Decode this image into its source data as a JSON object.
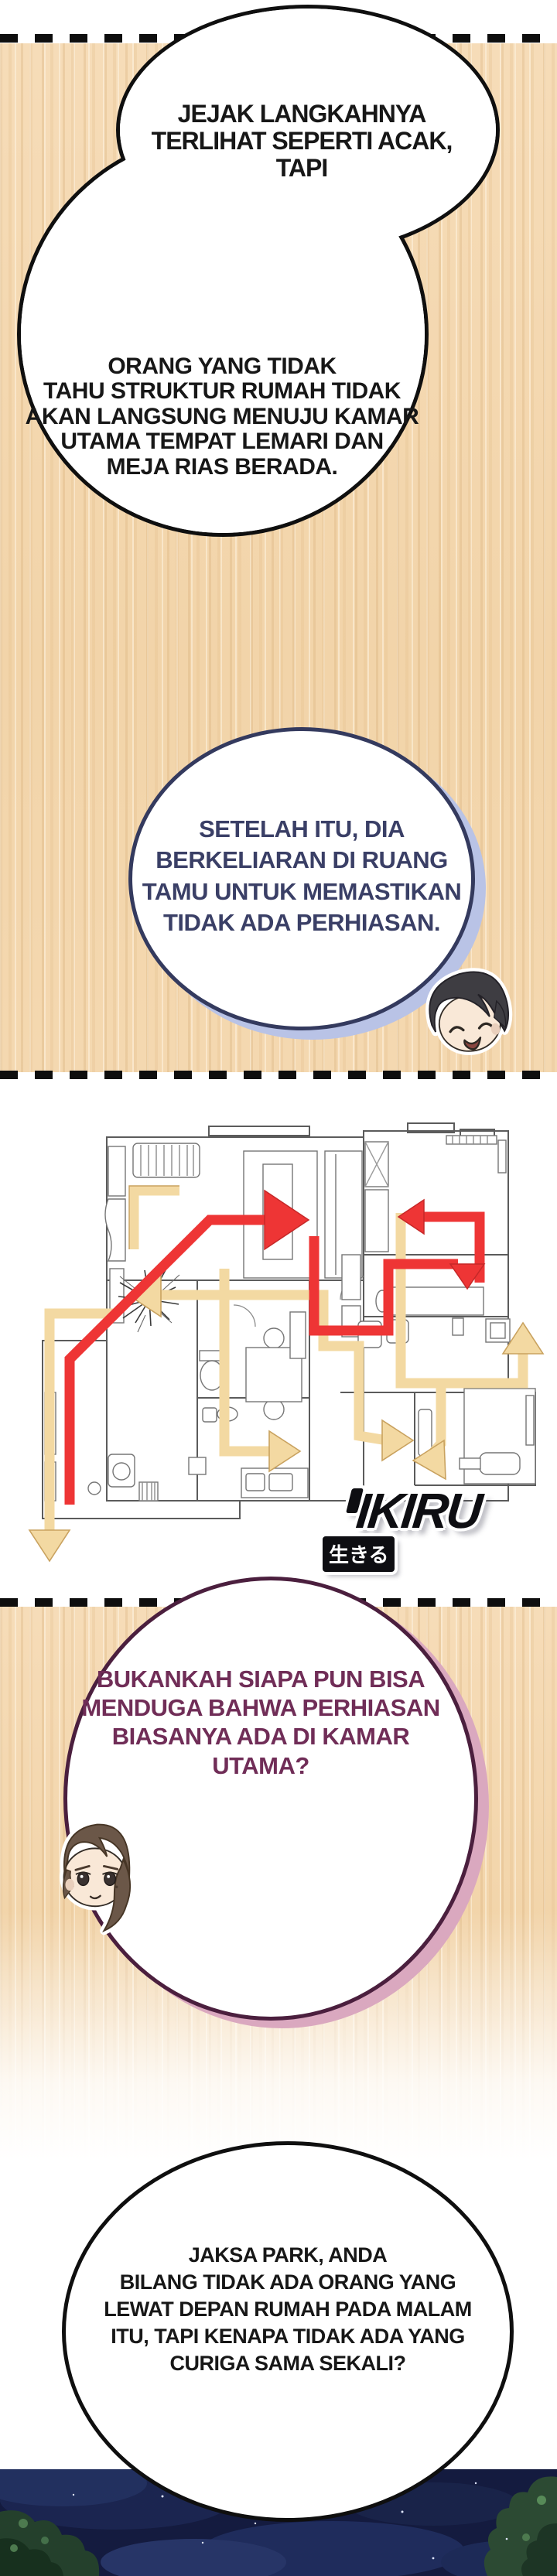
{
  "page": {
    "kind": "webtoon-comic-page",
    "language": "Indonesian"
  },
  "bubbles": [
    {
      "id": "bubble-1",
      "speaker": "narration",
      "text": "JEJAK LANGKAHNYA\nTERLIHAT SEPERTI ACAK,\nTAPI"
    },
    {
      "id": "bubble-2",
      "speaker": "narration",
      "text": "ORANG YANG TIDAK\nTAHU STRUKTUR RUMAH TIDAK\nAKAN LANGSUNG MENUJU KAMAR\nUTAMA TEMPAT LEMARI DAN\nMEJA RIAS BERADA."
    },
    {
      "id": "bubble-3",
      "speaker": "dark-haired-man",
      "text": "SETELAH ITU, DIA\nBERKELIARAN DI RUANG\nTAMU UNTUK MEMASTIKAN\nTIDAK ADA PERHIASAN."
    },
    {
      "id": "bubble-4",
      "speaker": "brown-haired-man",
      "text": "BUKANKAH SIAPA PUN BISA\nMENDUGA BAHWA PERHIASAN\nBIASANYA ADA DI KAMAR\nUTAMA?"
    },
    {
      "id": "bubble-5",
      "speaker": "narration",
      "text": "JAKSA PARK, ANDA\nBILANG TIDAK ADA ORANG YANG\nLEWAT DEPAN RUMAH PADA MALAM\nITU, TAPI KENAPA TIDAK ADA YANG\nCURIGA SAMA SEKALI?"
    }
  ],
  "watermark": {
    "brand": "IKIRU",
    "kanji": "生きる"
  },
  "floor_plan": {
    "description": "apartment floor plan with intruder routes",
    "route_colors": {
      "red_route": "#ee3535",
      "yellow_route": "#f3d9a2"
    }
  },
  "colors": {
    "wood_background": "#f3d6ae",
    "navy_bubble_border": "#343a5e",
    "navy_bubble_shadow": "#b9c3e6",
    "navy_text": "#3a3f66",
    "maroon_bubble_border": "#4b1f3e",
    "maroon_bubble_shadow": "#daa8bf",
    "maroon_text": "#702d57",
    "night_sky": "#141b3f"
  }
}
